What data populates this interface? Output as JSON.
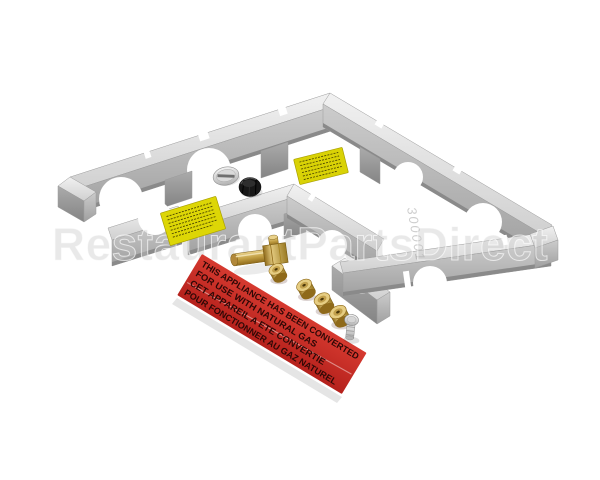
{
  "photo": {
    "background": "#ffffff",
    "subject": "gas-conversion-kit-product-photo"
  },
  "watermark": {
    "text": "RestaurantPartsDirect",
    "color": "#c9c9c9"
  },
  "metal_colors": {
    "top": "#ececec",
    "face": "#b4b4b4",
    "dark": "#8a8a8a"
  },
  "conversion_label": {
    "bg": "#cb2b24",
    "text_color": "#2e0806",
    "lines": [
      "THIS APPLIANCE HAS BEEN CONVERTED",
      "FOR USE WITH NATURAL GAS",
      "CET APPAREIL A ETE CONVERTIE",
      "POUR FONCTIONNER AU GAZ NATUREL"
    ]
  },
  "caution_labels": {
    "color": "#ddd606",
    "count": 2
  },
  "stamp_marking": {
    "text": "300001"
  },
  "parts": {
    "frame": "burner-frame-assembly",
    "orifice_elbow": "brass-elbow-orifice",
    "orifice_jets": "brass-orifice-jets",
    "jet_count": 4,
    "plug_silver": "slotted-plug",
    "plug_black": "black-cap-plug",
    "screw": "shoulder-screw"
  }
}
